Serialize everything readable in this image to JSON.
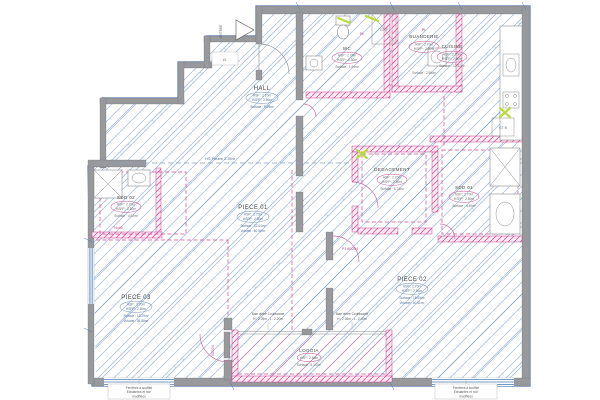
{
  "plan": {
    "landing": {
      "unit_tag": "#1."
    },
    "entry": {
      "label": "ENTREE"
    },
    "rooms": {
      "hall": {
        "name": "HALL",
        "hsp": "HSP : 2.70m",
        "hsfp": "HSFP : 2.50m",
        "surface": "Surface : 9.05m²"
      },
      "wc": {
        "name": "WC",
        "hsp": "HSP : 2.70m",
        "hsfp": "HSFP : 2.50m",
        "surface": "Surface : 1.94m²"
      },
      "buanderie": {
        "name": "BUANDERIE",
        "hsp": "HSP : 2.70m",
        "hsfp": "HSFP : 2.50m",
        "surface": "Surface : 2.99m²"
      },
      "cuisine": {
        "name": "CUISINE",
        "hsp": "HSP : 2.70m",
        "hsfp": "HSFP : 2.50m",
        "surface": "Surface : 12.51m²"
      },
      "degagement": {
        "name": "DEGAGEMENT",
        "hsp": "HSP : 2.70m",
        "hsfp": "HSFP : 2.50m",
        "surface": "Surface : 6.74m²"
      },
      "sdd01": {
        "name": "SDD 01",
        "hsp": "HSP : 2.70m",
        "hsfp": "HSFP : 2.50m",
        "surface": "Surface : 4.45m²"
      },
      "sdd02": {
        "name": "SDD 02",
        "hsp": "HSP : 2.70m",
        "hsfp": "HSFP : 2.50m",
        "surface": "Surface : 4.52m²"
      },
      "piece01": {
        "name": "PIECE 01",
        "hsp": "HSP : 2.70m",
        "hsfp": "HSFP : 2.50m",
        "surface": "Surface : 22.04m²",
        "volume": "Volume : 60.50m³"
      },
      "piece02": {
        "name": "PIECE 02",
        "hsp": "HSP : 2.70m",
        "hsfp": "HSFP : 2.50m",
        "surface": "Surface : 15.05m²",
        "volume": "Volume : 40.51m³"
      },
      "piece03": {
        "name": "PIECE 03",
        "hsp": "HSP : 2.70m",
        "hsfp": "HSFP : 2.50m",
        "surface": "Surface : 13.29m²",
        "volume": "Volume : 35.88m³"
      },
      "loggia": {
        "name": "LOGGIA",
        "hsp": "HSP : 2.56m",
        "surface": "Surface : 5.14 m²"
      }
    },
    "annotations": {
      "beam": "HS Poutre 2.35m",
      "door1": "P1 60/204",
      "door2": "90/204",
      "dim1": "74x90",
      "pl": "PL",
      "gt_p": "GT P",
      "gt_b": "GT B",
      "bay_label": "Baie vitrée Coulissante",
      "bay_dim": "H : 2.05m - L : 2.20m",
      "window_note_line1": "Fenêtres à soufflet",
      "window_note_line2": "Existantes et non",
      "window_note_line3": "modifiées"
    },
    "colors": {
      "hatch_blue": "#9db9da",
      "wall_gray": "#97999d",
      "magenta": "#d6479b",
      "green_highlight": "#b9dc3c",
      "blue_line": "#4a7ab5"
    }
  }
}
